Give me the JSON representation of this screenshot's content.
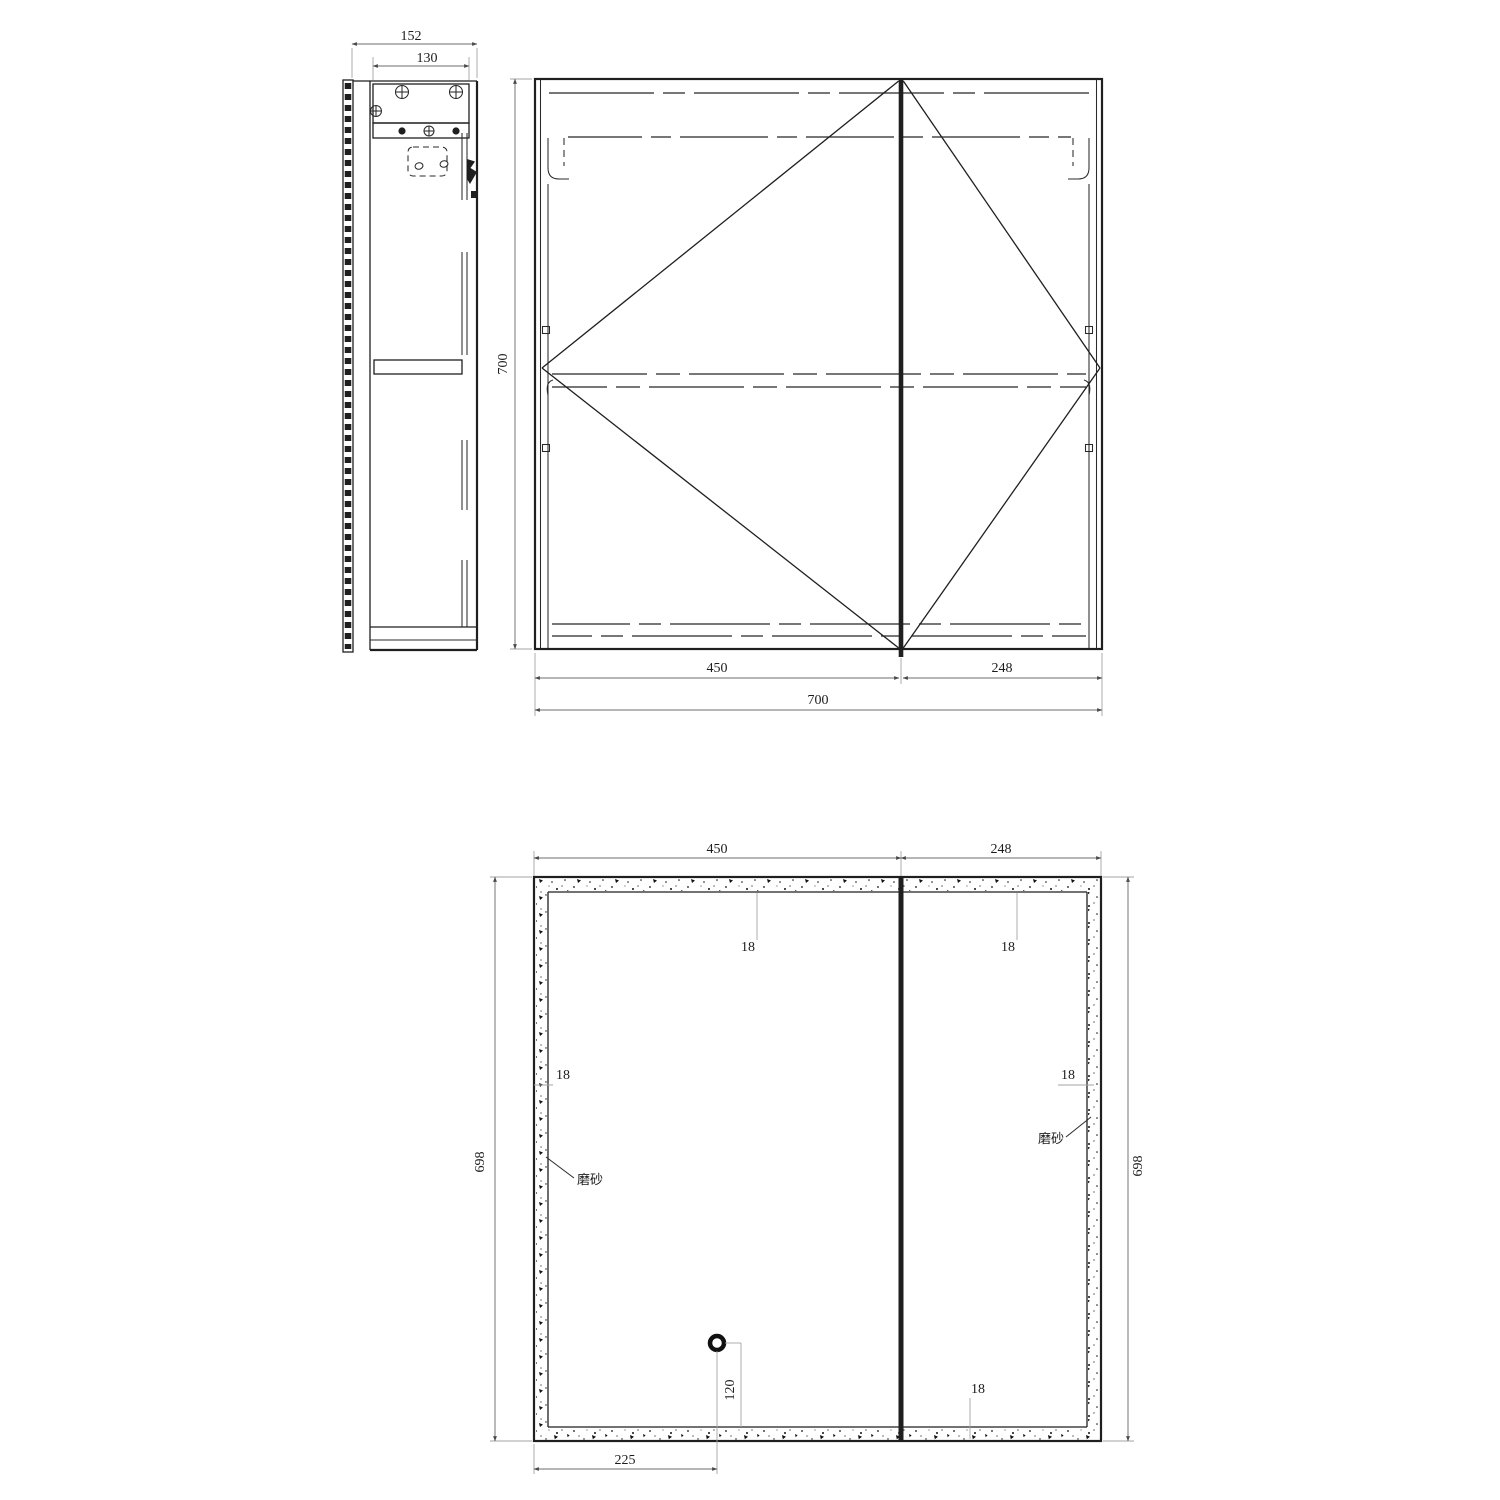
{
  "sheet": {
    "background": "#ffffff",
    "line_color": "#1f1f1f"
  },
  "side_view": {
    "dims": {
      "overall_depth": "152",
      "mount_rail_width": "130"
    }
  },
  "front_view": {
    "dims": {
      "height": "700",
      "left_door_width": "450",
      "right_door_width": "248",
      "overall_width": "700"
    }
  },
  "panel_view": {
    "dims": {
      "left_panel_width": "450",
      "right_panel_width": "248",
      "left_panel_height": "698",
      "right_panel_height": "698",
      "frost_top_left": "18",
      "frost_top_right": "18",
      "frost_side_left": "18",
      "frost_side_right": "18",
      "frost_bottom": "18",
      "hole_from_left": "225",
      "hole_from_bottom": "120"
    },
    "labels": {
      "frost_left": "磨砂",
      "frost_right": "磨砂"
    }
  }
}
